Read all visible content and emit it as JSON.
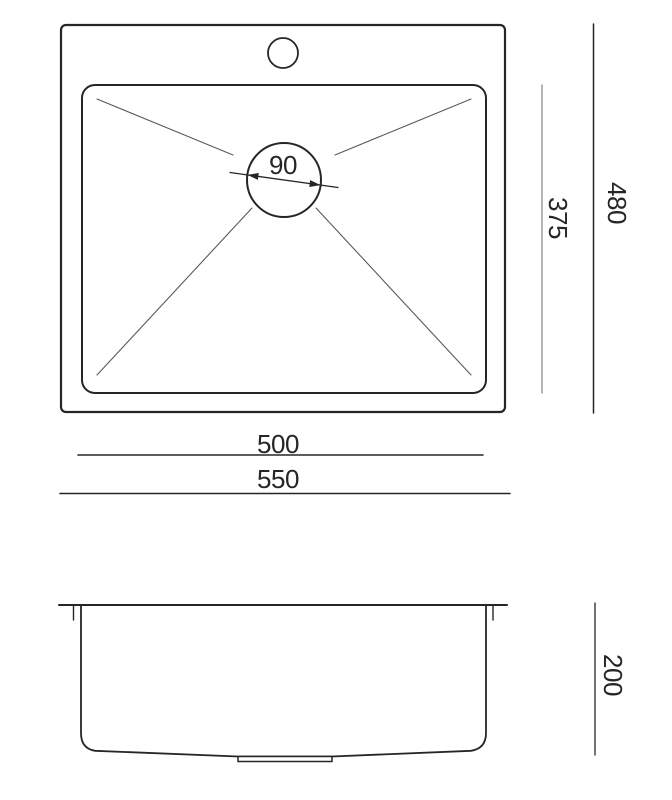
{
  "drawing": {
    "labels": {
      "drain_diameter": "90",
      "inner_depth": "375",
      "outer_depth": "480",
      "inner_width": "500",
      "outer_width": "550",
      "bowl_height": "200"
    },
    "colors": {
      "background": "#ffffff",
      "primary_line": "#262626",
      "secondary_line": "#5a5a5a",
      "light_dimension_line": "#8c8c8c",
      "text": "#262626"
    }
  }
}
